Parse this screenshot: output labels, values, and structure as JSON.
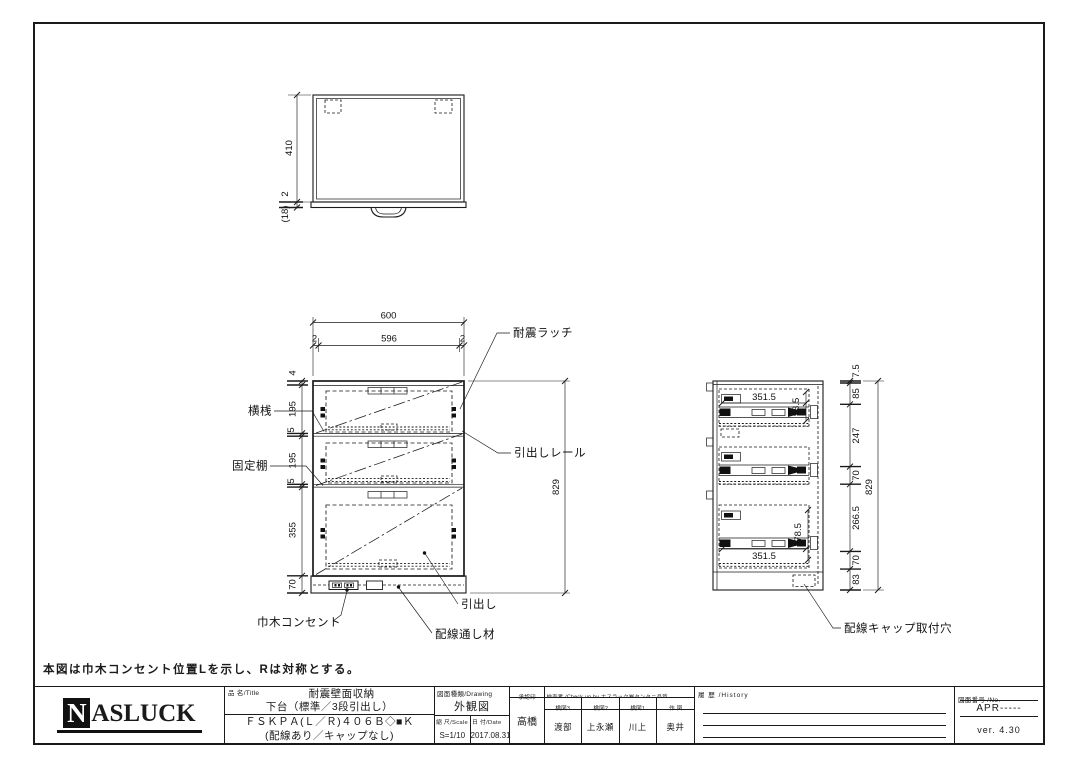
{
  "colors": {
    "line": "#1a1a1a",
    "background": "#ffffff"
  },
  "note": "本図は巾木コンセント位置Lを示し、Rは対称とする。",
  "top_view": {
    "dim_height": "410",
    "dim_lip": "2",
    "dim_base": "(18)"
  },
  "front_view": {
    "dim_width_total": "600",
    "dim_edge_left": "2",
    "dim_width_inner": "596",
    "dim_edge_right": "2",
    "dim_top_panel": "4",
    "dim_drawer1": "195",
    "dim_shelf1": "5",
    "dim_drawer2": "195",
    "dim_shelf2": "5",
    "dim_drawer3": "355",
    "dim_base": "70",
    "dim_height_total": "829",
    "labels": {
      "latch": "耐震ラッチ",
      "rail": "引出しレール",
      "crossbar": "横桟",
      "fixed_shelf": "固定棚",
      "drawer": "引出し",
      "outlet": "巾木コンセント",
      "wiring": "配線通し材"
    }
  },
  "side_view": {
    "dim_rail_top": "351.5",
    "dim_rail_top_height": "98.5",
    "dim_rail_bottom": "351.5",
    "dim_rail_bottom_height": "178.5",
    "chain": [
      "7.5",
      "85",
      "247",
      "70",
      "266.5",
      "70",
      "83"
    ],
    "dim_height_total": "829",
    "label_cap_hole": "配線キャップ取付穴"
  },
  "title_block": {
    "logo_initial": "N",
    "logo_rest": "ASLUCK",
    "title_header": "品 名/Title",
    "title_line1": "耐震壁面収納",
    "title_line2": "下台（標準／3段引出し）",
    "title_line3": "ＦＳＫＰＡ(Ｌ／Ｒ)４０６Ｂ◇■Ｋ",
    "title_line4": "(配線あり／キャップなし)",
    "drawing_header": "図面種類/Drawing",
    "drawing_type": "外観図",
    "scale_header": "縮 尺/Scale",
    "scale": "S=1/10",
    "date_header": "日 付/Date",
    "date": "2017.08.31",
    "approval_header": "承認印",
    "approval_name": "高橋",
    "check_header": "検査者 /Check up by ナスラック㈱タンタニ品質",
    "check_cols": [
      {
        "role": "検図3",
        "name": "渡部"
      },
      {
        "role": "検図2",
        "name": "上永瀬"
      },
      {
        "role": "検図1",
        "name": "川上"
      },
      {
        "role": "作 図",
        "name": "奥井"
      }
    ],
    "history_header": "履 歴 /History",
    "no_header": "図面番号 /No.",
    "drawing_no": "APR-----",
    "version": "ver. 4.30"
  }
}
